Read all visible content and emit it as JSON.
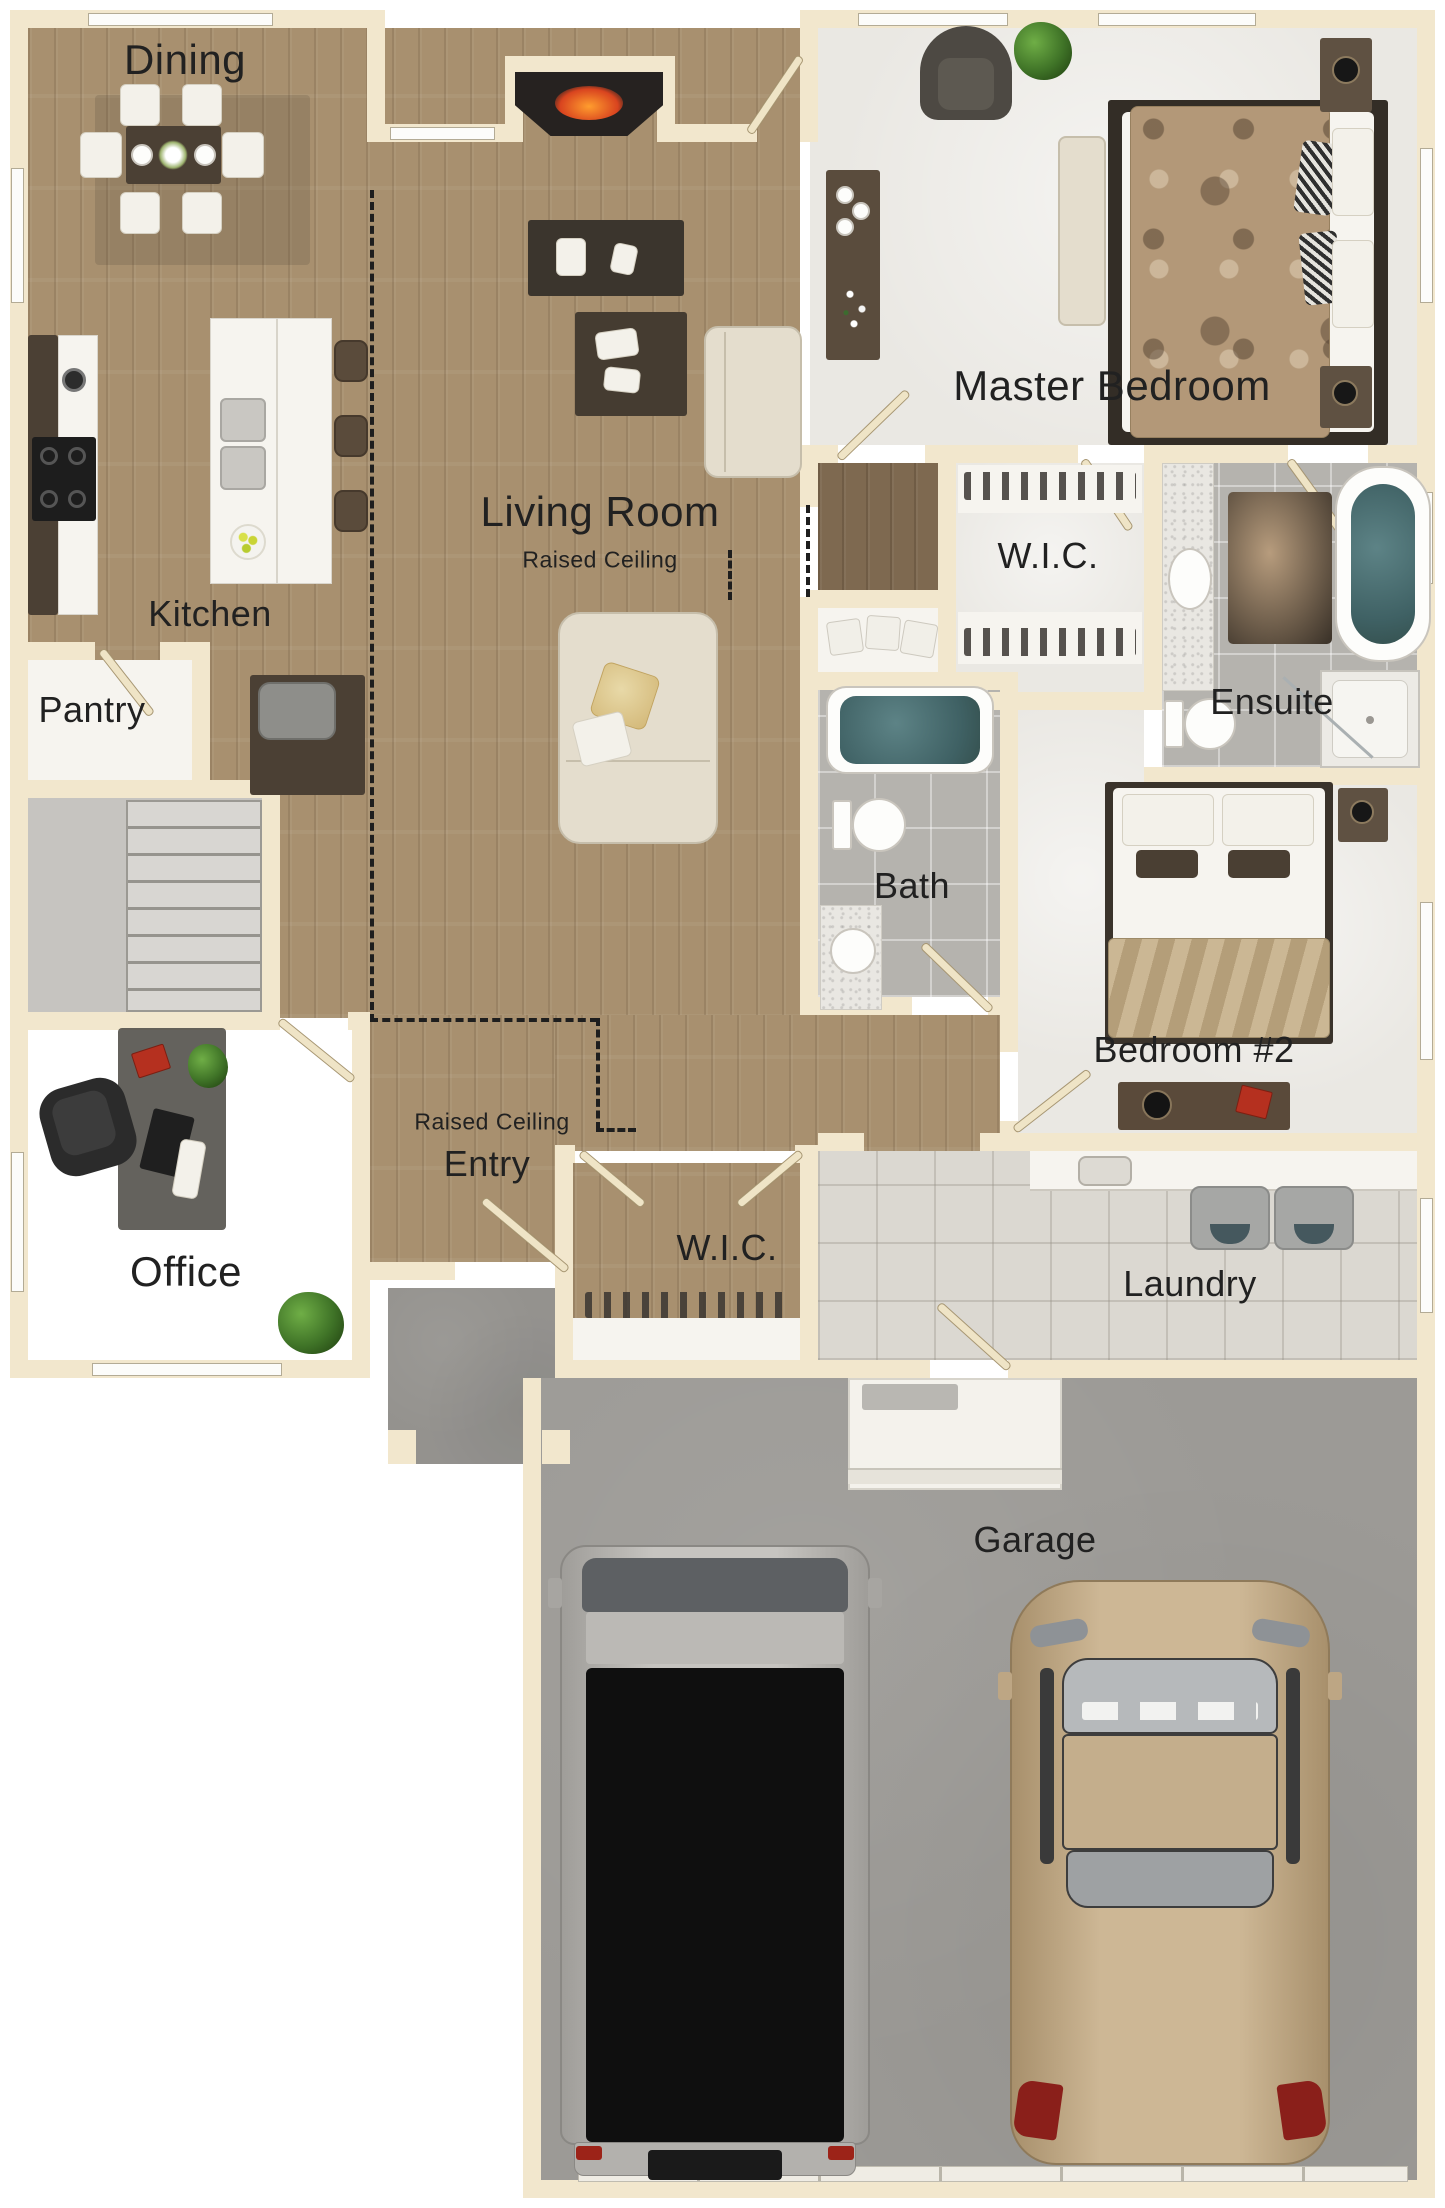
{
  "title": "Residential Floor Plan",
  "colors": {
    "wall": "#f2e7cd",
    "wood_floor": "#a8906f",
    "dark_wood_floor": "#7e6950",
    "carpet": "#eae8e3",
    "tile": "#b5b3ae",
    "light_tile": "#dbd8d1",
    "concrete": "#9c9a96",
    "tub_water": "#4f7376",
    "label_text": "#212121"
  },
  "rooms": {
    "dining": {
      "label": "Dining"
    },
    "master_bedroom": {
      "label": "Master Bedroom"
    },
    "living_room": {
      "label": "Living Room",
      "sublabel": "Raised Ceiling"
    },
    "master_wic": {
      "label": "W.I.C."
    },
    "ensuite": {
      "label": "Ensuite"
    },
    "kitchen": {
      "label": "Kitchen"
    },
    "pantry": {
      "label": "Pantry"
    },
    "bath": {
      "label": "Bath"
    },
    "bedroom2": {
      "label": "Bedroom #2"
    },
    "office": {
      "label": "Office"
    },
    "entry": {
      "label": "Entry",
      "sublabel": "Raised Ceiling"
    },
    "entry_wic": {
      "label": "W.I.C."
    },
    "laundry": {
      "label": "Laundry"
    },
    "garage": {
      "label": "Garage"
    }
  }
}
